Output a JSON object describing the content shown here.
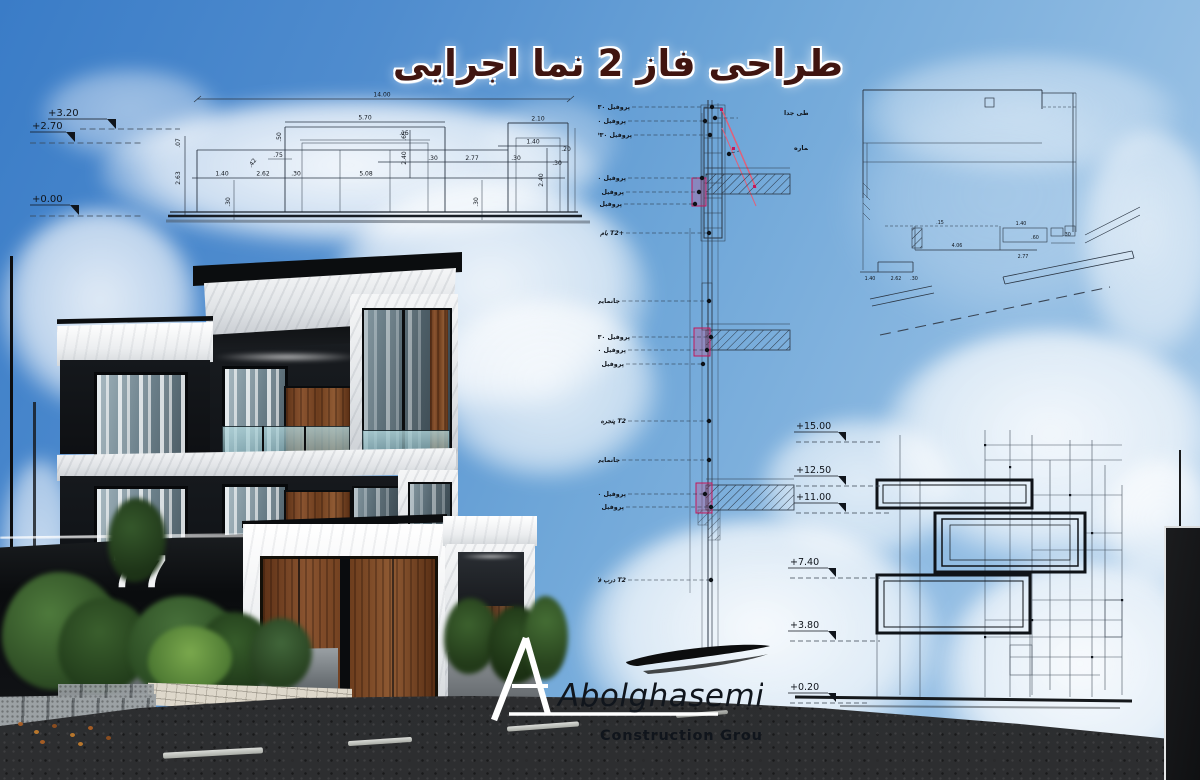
{
  "title": "طراحی فاز 2 نما اجرایی",
  "logo": {
    "name": "Abolghasemi",
    "subtitle": "Construction Group"
  },
  "render": {
    "house_number": "77"
  },
  "left_elevation": {
    "levels": {
      "top": "+3.20",
      "mid": "+2.70",
      "base": "+0.00"
    },
    "dims": {
      "total": "14.00",
      "w570": "5.70",
      "w210": "2.10",
      "w015": ".15",
      "w140r": "1.40",
      "w030a": ".30",
      "w277": "2.77",
      "w030b": ".30",
      "w020": ".20",
      "w030c": ".30",
      "w075": ".75",
      "w042": ".42",
      "h050": ".50",
      "h007": ".07",
      "h263": "2.63",
      "w140b": "1.40",
      "w262": "2.62",
      "w030d": ".30",
      "w508": "5.08",
      "h240": "2.40",
      "h065": ".65",
      "h240r": "2.40",
      "h030a": ".30",
      "h030b": ".30"
    }
  },
  "wall_section": {
    "profile": "پروفیل ۳۰*۳۰",
    "box": "قوطی جدا",
    "flashing": "فلاشینگ شماره A",
    "roof": "بام T2+",
    "curtain_wall": "جانمایی شبکه کرتین وال",
    "window": "پنجره T2",
    "door": "درب فلزی سواره T2"
  },
  "detail_top_right": {
    "dims": {
      "a": ".15",
      "b": "1.40",
      "c": ".60",
      "d": ".30",
      "e": "4.06",
      "f": "2.77",
      "g": "1.40",
      "h": "2.62",
      "i": ".30"
    }
  },
  "right_elevation": {
    "levels": {
      "l1": "+15.00",
      "l2": "+12.50",
      "l3": "+11.00",
      "l4": "+7.40",
      "l5": "+3.80",
      "l6": "+0.20"
    }
  }
}
